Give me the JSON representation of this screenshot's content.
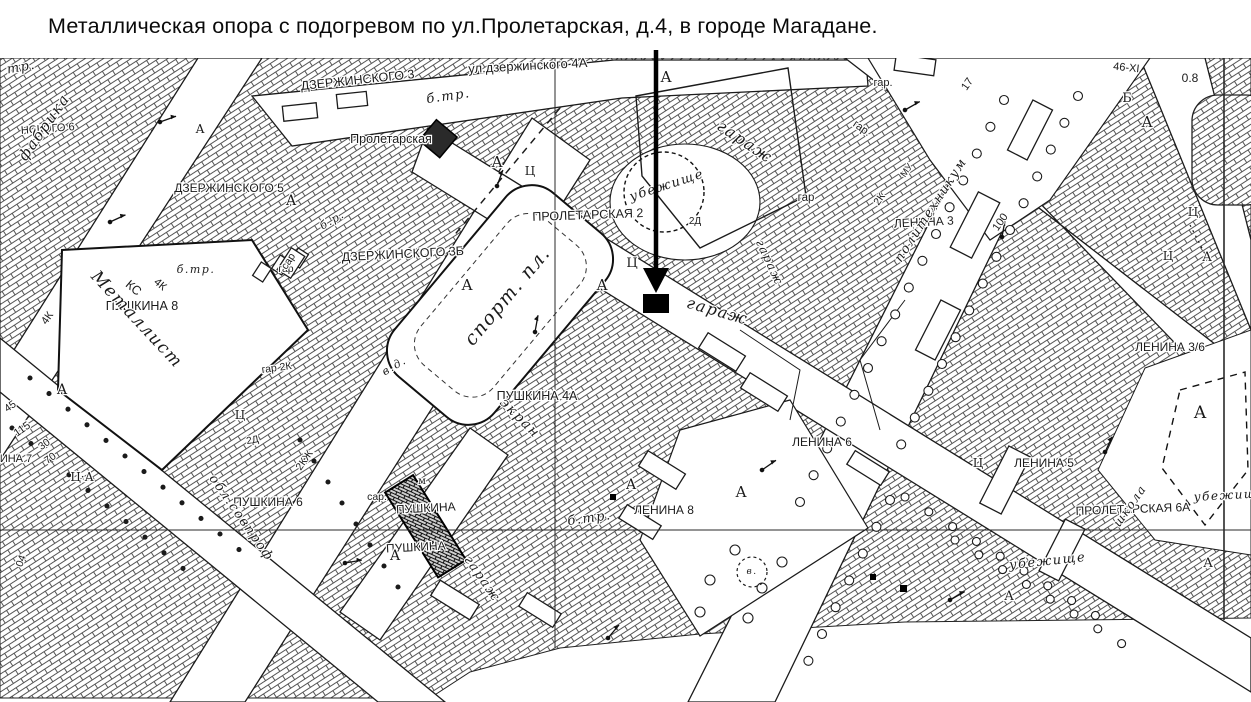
{
  "title": {
    "text": "Металлическая опора с подогревом по ул.Пролетарская, д.4, в городе Магадане."
  },
  "map": {
    "ink": "#1f1f1f",
    "paper": "#ffffff",
    "marker": {
      "shape": "filled-square",
      "color": "#000000"
    },
    "labels": [
      {
        "t": "ул.дзержинского 4А",
        "x": 528,
        "y": 70,
        "r": -3,
        "s": 13,
        "c": "sans"
      },
      {
        "t": "ДЗЕРЖИНСКОГО 3",
        "x": 358,
        "y": 84,
        "r": -6,
        "s": 12.5,
        "c": "sans"
      },
      {
        "t": "ДЗЕРЖИНСКОГО 5",
        "x": 229,
        "y": 192,
        "r": 0,
        "s": 12,
        "c": "sans"
      },
      {
        "t": "ДЗЕРЖИНСКОГО 3Б",
        "x": 403,
        "y": 258,
        "r": -3,
        "s": 12.5,
        "c": "sans"
      },
      {
        "t": "Пролетарская",
        "x": 391,
        "y": 143,
        "r": 0,
        "s": 12.5,
        "c": "sans"
      },
      {
        "t": "ПРОЛЕТАРСКАЯ 2",
        "x": 588,
        "y": 219,
        "r": -2,
        "s": 12.5,
        "c": "sans"
      },
      {
        "t": "ПУШКИНА 8",
        "x": 142,
        "y": 310,
        "r": 0,
        "s": 12.5,
        "c": "sans"
      },
      {
        "t": "ПУШКИНА 4А",
        "x": 537,
        "y": 400,
        "r": 0,
        "s": 12.5,
        "c": "sans"
      },
      {
        "t": "ПУШКИНА 6",
        "x": 268,
        "y": 506,
        "r": 0,
        "s": 12,
        "c": "sans"
      },
      {
        "t": "ПУШКИНА",
        "x": 426,
        "y": 512,
        "r": -3,
        "s": 12,
        "c": "sans"
      },
      {
        "t": "ПУШКИНА",
        "x": 416,
        "y": 551,
        "r": -3,
        "s": 12,
        "c": "sans"
      },
      {
        "t": "ЛЕНИНА 8",
        "x": 664,
        "y": 514,
        "r": 0,
        "s": 12,
        "c": "sans"
      },
      {
        "t": "ЛЕНИНА 6",
        "x": 822,
        "y": 446,
        "r": 0,
        "s": 12,
        "c": "sans"
      },
      {
        "t": "ЛЕНИНА 5",
        "x": 1044,
        "y": 467,
        "r": 0,
        "s": 12,
        "c": "sans"
      },
      {
        "t": "ЛЕНИНА 3",
        "x": 924,
        "y": 226,
        "r": -3,
        "s": 12,
        "c": "sans"
      },
      {
        "t": "ЛЕНИНА 3/6",
        "x": 1170,
        "y": 351,
        "r": 0,
        "s": 12,
        "c": "sans"
      },
      {
        "t": "ПРОЛЕТАРСКАЯ 6А",
        "x": 1133,
        "y": 513,
        "r": -2,
        "s": 12,
        "c": "sans"
      },
      {
        "t": "НСКОГО 6",
        "x": 48,
        "y": 132,
        "r": -4,
        "s": 11,
        "c": "sans"
      },
      {
        "t": "ИНА 7",
        "x": 16,
        "y": 462,
        "r": 0,
        "s": 11,
        "c": "sans"
      },
      {
        "t": "гар.",
        "x": 883,
        "y": 86,
        "r": 0,
        "s": 11,
        "c": "sans"
      },
      {
        "t": "гар",
        "x": 806,
        "y": 201,
        "r": 0,
        "s": 11.5,
        "c": "sans"
      },
      {
        "t": "гар.",
        "x": 860,
        "y": 131,
        "r": 35,
        "s": 11,
        "c": "sans"
      },
      {
        "t": "гар",
        "x": 286,
        "y": 272,
        "r": 0,
        "s": 10.5,
        "c": "sans"
      },
      {
        "t": "гар 2К",
        "x": 277,
        "y": 371,
        "r": -8,
        "s": 10.5,
        "c": "sans"
      },
      {
        "t": "сар",
        "x": 291,
        "y": 263,
        "r": -57,
        "s": 10.5,
        "c": "sans"
      },
      {
        "t": "сар.",
        "x": 377,
        "y": 500,
        "r": 0,
        "s": 10.5,
        "c": "sans"
      },
      {
        "t": "2Д",
        "x": 695,
        "y": 224,
        "r": 0,
        "s": 10,
        "c": "sans"
      },
      {
        "t": "2Д",
        "x": 253,
        "y": 443,
        "r": -10,
        "s": 10,
        "c": "sans"
      },
      {
        "t": "2КЖ",
        "x": 307,
        "y": 462,
        "r": -55,
        "s": 10.5,
        "c": "sans"
      },
      {
        "t": "2К",
        "x": 882,
        "y": 201,
        "r": -55,
        "s": 10.5,
        "c": "sans"
      },
      {
        "t": "МУ",
        "x": 909,
        "y": 172,
        "r": -55,
        "s": 9.5,
        "c": "sans"
      },
      {
        "t": "46-ХI",
        "x": 1126,
        "y": 71,
        "r": 6,
        "s": 11,
        "c": "sans"
      },
      {
        "t": "0.8",
        "x": 1190,
        "y": 82,
        "r": 0,
        "s": 12,
        "c": "sans"
      },
      {
        "t": "17",
        "x": 970,
        "y": 86,
        "r": -55,
        "s": 11,
        "c": "sans"
      },
      {
        "t": "100",
        "x": 1003,
        "y": 224,
        "r": -55,
        "s": 11,
        "c": "sans"
      },
      {
        "t": "115",
        "x": 24,
        "y": 432,
        "r": -35,
        "s": 11,
        "c": "sans"
      },
      {
        "t": "30",
        "x": 46,
        "y": 447,
        "r": -35,
        "s": 10.5,
        "c": "sans"
      },
      {
        "t": "70",
        "x": 52,
        "y": 461,
        "r": -35,
        "s": 10.5,
        "c": "sans"
      },
      {
        "t": "45",
        "x": 12,
        "y": 409,
        "r": -35,
        "s": 10.5,
        "c": "sans"
      },
      {
        "t": "04",
        "x": 24,
        "y": 562,
        "r": -70,
        "s": 10.5,
        "c": "sans"
      },
      {
        "t": "4К",
        "x": 50,
        "y": 320,
        "r": -55,
        "s": 11,
        "c": "sans"
      },
      {
        "t": "КС",
        "x": 131,
        "y": 291,
        "r": 40,
        "s": 12.5,
        "c": "sans"
      },
      {
        "t": "4К",
        "x": 158,
        "y": 287,
        "r": 40,
        "s": 11,
        "c": "sans"
      },
      {
        "t": "А",
        "x": 666,
        "y": 82,
        "r": 0,
        "s": 15,
        "c": "cap"
      },
      {
        "t": "А",
        "x": 291,
        "y": 205,
        "r": 0,
        "s": 14,
        "c": "cap"
      },
      {
        "t": "А",
        "x": 200,
        "y": 133,
        "r": 0,
        "s": 12,
        "c": "cap"
      },
      {
        "t": "А",
        "x": 497,
        "y": 167,
        "r": 0,
        "s": 15,
        "c": "cap"
      },
      {
        "t": "А",
        "x": 602,
        "y": 290,
        "r": 0,
        "s": 15,
        "c": "cap"
      },
      {
        "t": "А",
        "x": 467,
        "y": 290,
        "r": 0,
        "s": 15,
        "c": "cap"
      },
      {
        "t": "А",
        "x": 631,
        "y": 489,
        "r": 0,
        "s": 14,
        "c": "cap"
      },
      {
        "t": "А",
        "x": 741,
        "y": 497,
        "r": 0,
        "s": 15,
        "c": "cap"
      },
      {
        "t": "А",
        "x": 395,
        "y": 560,
        "r": 0,
        "s": 14,
        "c": "cap"
      },
      {
        "t": "А",
        "x": 1147,
        "y": 127,
        "r": 0,
        "s": 15,
        "c": "cap"
      },
      {
        "t": "А",
        "x": 1207,
        "y": 261,
        "r": 0,
        "s": 13,
        "c": "cap"
      },
      {
        "t": "А",
        "x": 1200,
        "y": 418,
        "r": 0,
        "s": 17,
        "c": "cap"
      },
      {
        "t": "А",
        "x": 1208,
        "y": 567,
        "r": 0,
        "s": 13,
        "c": "cap"
      },
      {
        "t": "А",
        "x": 1009,
        "y": 600,
        "r": 0,
        "s": 13,
        "c": "cap"
      },
      {
        "t": "А",
        "x": 62,
        "y": 394,
        "r": 0,
        "s": 14,
        "c": "cap"
      },
      {
        "t": "Ц",
        "x": 530,
        "y": 175,
        "r": 0,
        "s": 12,
        "c": "cap"
      },
      {
        "t": "Ц",
        "x": 632,
        "y": 267,
        "r": 0,
        "s": 13,
        "c": "cap"
      },
      {
        "t": "Ц",
        "x": 978,
        "y": 467,
        "r": 0,
        "s": 12,
        "c": "cap"
      },
      {
        "t": "Ц",
        "x": 1193,
        "y": 216,
        "r": 0,
        "s": 12,
        "c": "cap"
      },
      {
        "t": "Ц",
        "x": 1168,
        "y": 260,
        "r": 0,
        "s": 12,
        "c": "cap"
      },
      {
        "t": "Ц",
        "x": 240,
        "y": 419,
        "r": 0,
        "s": 12,
        "c": "cap"
      },
      {
        "t": "Ц·А",
        "x": 82,
        "y": 481,
        "r": 0,
        "s": 12,
        "c": "cap"
      },
      {
        "t": "Б",
        "x": 1127,
        "y": 102,
        "r": 0,
        "s": 13,
        "c": "cap"
      },
      {
        "t": "м",
        "x": 422,
        "y": 484,
        "r": 0,
        "s": 10,
        "c": "cap"
      },
      {
        "t": "фабрика",
        "x": 48,
        "y": 130,
        "r": -55,
        "s": 15,
        "c": "cur"
      },
      {
        "t": "Металлист",
        "x": 133,
        "y": 323,
        "r": 47,
        "s": 17,
        "c": "cur"
      },
      {
        "t": "спорт. пл.",
        "x": 512,
        "y": 300,
        "r": -50,
        "s": 19,
        "c": "cur"
      },
      {
        "t": "экран",
        "x": 517,
        "y": 421,
        "r": 45,
        "s": 14,
        "c": "cur"
      },
      {
        "t": "обл.совпроф",
        "x": 238,
        "y": 520,
        "r": 55,
        "s": 13,
        "c": "cur"
      },
      {
        "t": "гараж",
        "x": 742,
        "y": 146,
        "r": 34,
        "s": 16,
        "c": "cur"
      },
      {
        "t": "гараж",
        "x": 716,
        "y": 316,
        "r": 16,
        "s": 16,
        "c": "cur"
      },
      {
        "t": "гараж",
        "x": 766,
        "y": 264,
        "r": 65,
        "s": 12,
        "c": "cur"
      },
      {
        "t": "гараж",
        "x": 479,
        "y": 581,
        "r": 55,
        "s": 13,
        "c": "cur"
      },
      {
        "t": "убежище",
        "x": 668,
        "y": 189,
        "r": -18,
        "s": 13,
        "c": "cur"
      },
      {
        "t": "убежище",
        "x": 1048,
        "y": 565,
        "r": -6,
        "s": 13,
        "c": "cur"
      },
      {
        "t": "убежище",
        "x": 1230,
        "y": 499,
        "r": -3,
        "s": 12,
        "c": "cur"
      },
      {
        "t": "политехникум",
        "x": 934,
        "y": 212,
        "r": -57,
        "s": 13,
        "c": "cur"
      },
      {
        "t": "школа",
        "x": 1133,
        "y": 508,
        "r": -55,
        "s": 12,
        "c": "cur"
      },
      {
        "t": "б.тр.",
        "x": 449,
        "y": 100,
        "r": -8,
        "s": 13,
        "c": "cur"
      },
      {
        "t": "б.тр.",
        "x": 196,
        "y": 273,
        "r": 0,
        "s": 11,
        "c": "cur"
      },
      {
        "t": "б.тр.",
        "x": 590,
        "y": 522,
        "r": -8,
        "s": 13,
        "c": "cur"
      },
      {
        "t": "б.р.",
        "x": 334,
        "y": 223,
        "r": -30,
        "s": 11,
        "c": "cur"
      },
      {
        "t": "в.д.",
        "x": 396,
        "y": 369,
        "r": -30,
        "s": 11,
        "c": "cur"
      },
      {
        "t": "тр.",
        "x": 22,
        "y": 71,
        "r": -10,
        "s": 13,
        "c": "cur"
      },
      {
        "t": "в.",
        "x": 752,
        "y": 574,
        "r": 0,
        "s": 9,
        "c": "cur"
      }
    ]
  }
}
